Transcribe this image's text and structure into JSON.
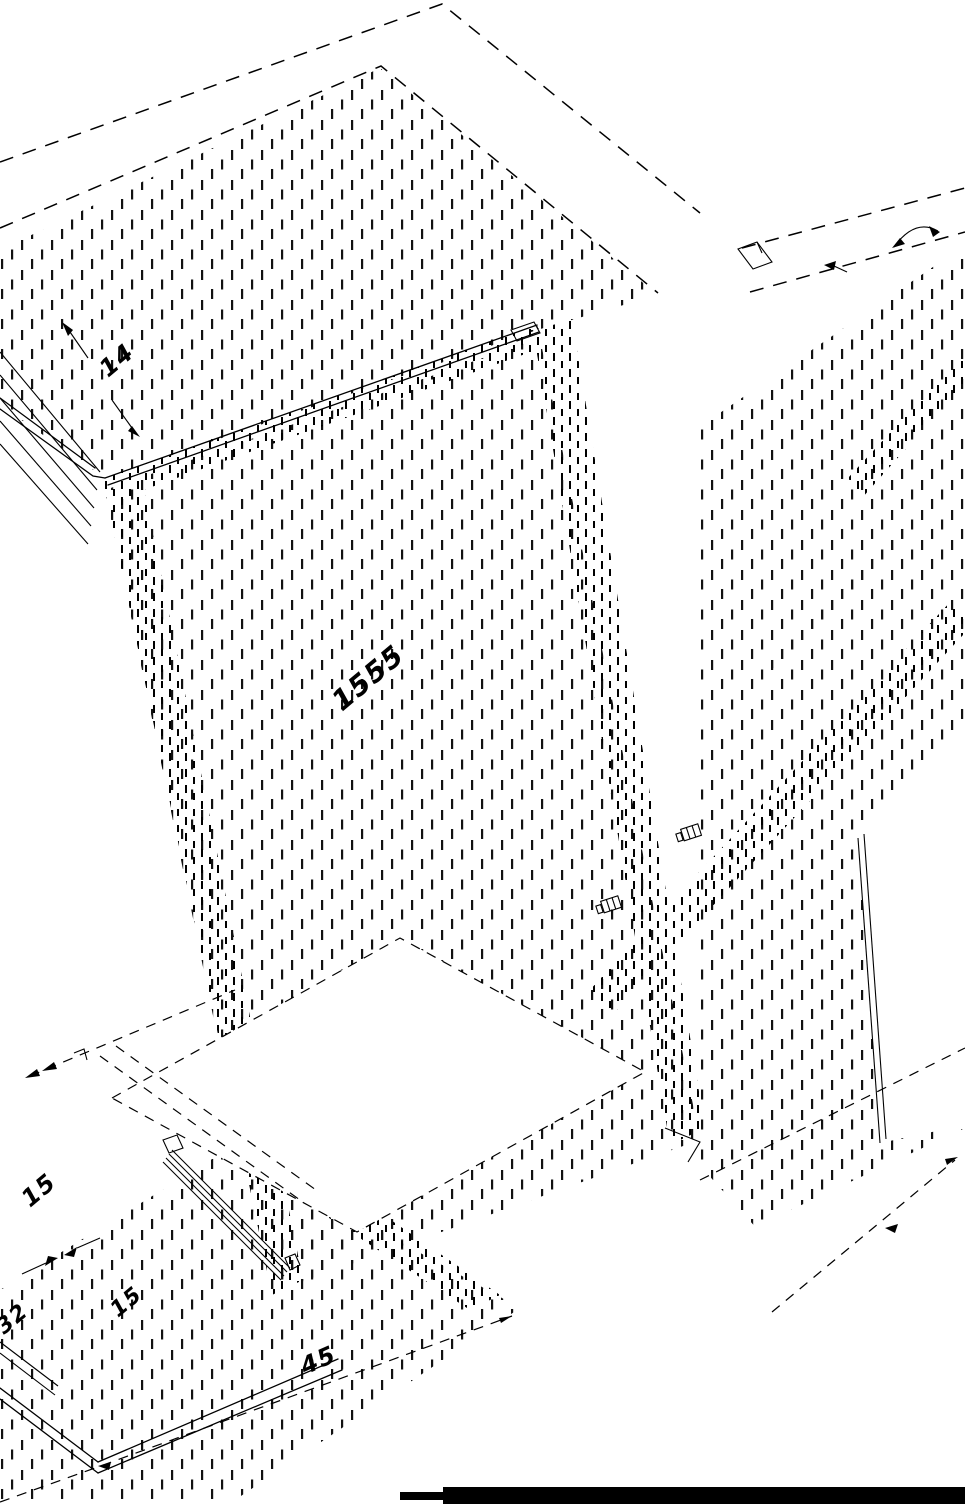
{
  "drawing": {
    "background_color": "#ffffff",
    "line_color": "#000000",
    "footer_bar_color": "#000000",
    "dimensions": {
      "panel_thickness_top": "14",
      "panel_length_center": "1555",
      "drawer_dim_upper": "15",
      "drawer_dim_left": "32",
      "drawer_dim_lower": "15",
      "base_dim_bottom": "45"
    }
  }
}
